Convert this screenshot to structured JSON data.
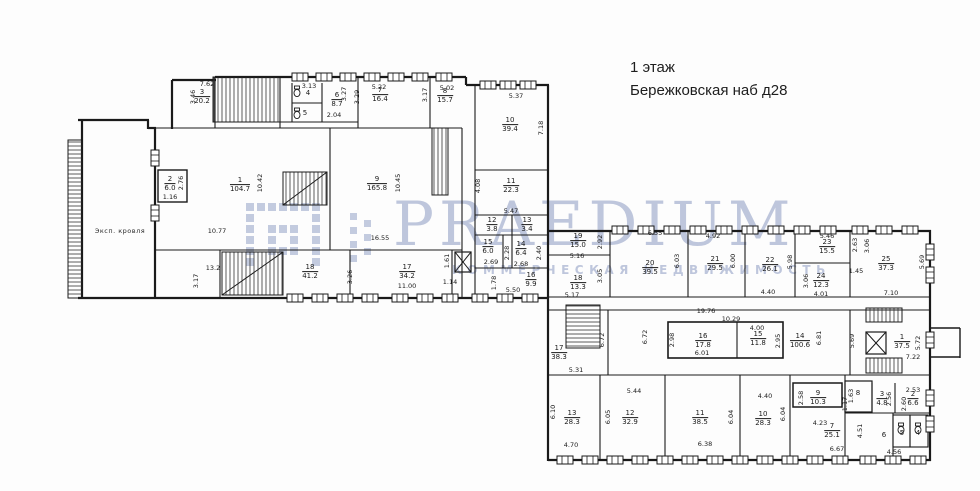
{
  "title": {
    "floor": "1 этаж",
    "address": "Бережковская наб д28"
  },
  "watermark": {
    "brand": "PRAEDIUM",
    "subtitle": "КОММЕРЧЕСКАЯ НЕДВИЖИМОСТЬ",
    "color": "#94a2c6"
  },
  "annotations": {
    "roof": "Эксп. кровля"
  },
  "floorplan": {
    "rooms": [
      {
        "num": "3",
        "area": "20.2",
        "x": 202,
        "y": 97
      },
      {
        "num": "6",
        "area": "8.7",
        "x": 337,
        "y": 100
      },
      {
        "num": "7",
        "area": "16.4",
        "x": 380,
        "y": 95
      },
      {
        "num": "8",
        "area": "15.7",
        "x": 445,
        "y": 96
      },
      {
        "num": "10",
        "area": "39.4",
        "x": 510,
        "y": 125
      },
      {
        "num": "11",
        "area": "22.3",
        "x": 511,
        "y": 186
      },
      {
        "num": "12",
        "area": "3.8",
        "x": 492,
        "y": 225
      },
      {
        "num": "13",
        "area": "3.4",
        "x": 527,
        "y": 225
      },
      {
        "num": "15",
        "area": "6.0",
        "x": 488,
        "y": 247
      },
      {
        "num": "14",
        "area": "6.4",
        "x": 521,
        "y": 249
      },
      {
        "num": "16",
        "area": "9.9",
        "x": 531,
        "y": 280
      },
      {
        "num": "2",
        "area": "6.0",
        "x": 170,
        "y": 184
      },
      {
        "num": "1",
        "area": "104.7",
        "x": 240,
        "y": 185
      },
      {
        "num": "9",
        "area": "165.8",
        "x": 377,
        "y": 184
      },
      {
        "num": "18",
        "area": "41.2",
        "x": 310,
        "y": 272
      },
      {
        "num": "17",
        "area": "34.2",
        "x": 407,
        "y": 272
      },
      {
        "num": "19",
        "area": "15.0",
        "x": 578,
        "y": 241
      },
      {
        "num": "18",
        "area": "13.3",
        "x": 578,
        "y": 283
      },
      {
        "num": "20",
        "area": "39.5",
        "x": 650,
        "y": 268
      },
      {
        "num": "21",
        "area": "29.5",
        "x": 715,
        "y": 264
      },
      {
        "num": "22",
        "area": "26.1",
        "x": 770,
        "y": 265
      },
      {
        "num": "23",
        "area": "15.5",
        "x": 827,
        "y": 247
      },
      {
        "num": "24",
        "area": "12.3",
        "x": 821,
        "y": 281
      },
      {
        "num": "25",
        "area": "37.3",
        "x": 886,
        "y": 264
      },
      {
        "num": "17",
        "area": "38.3",
        "x": 559,
        "y": 353
      },
      {
        "num": "16",
        "area": "17.8",
        "x": 703,
        "y": 341
      },
      {
        "num": "15",
        "area": "11.8",
        "x": 758,
        "y": 339
      },
      {
        "num": "14",
        "area": "100.6",
        "x": 800,
        "y": 341
      },
      {
        "num": "1",
        "area": "37.5",
        "x": 902,
        "y": 342
      },
      {
        "num": "13",
        "area": "28.3",
        "x": 572,
        "y": 418
      },
      {
        "num": "12",
        "area": "32.9",
        "x": 630,
        "y": 418
      },
      {
        "num": "11",
        "area": "38.5",
        "x": 700,
        "y": 418
      },
      {
        "num": "10",
        "area": "28.3",
        "x": 763,
        "y": 419
      },
      {
        "num": "9",
        "area": "10.3",
        "x": 818,
        "y": 398
      },
      {
        "num": "7",
        "area": "25.1",
        "x": 832,
        "y": 431
      },
      {
        "num": "3",
        "area": "4.8",
        "x": 882,
        "y": 399
      },
      {
        "num": "2",
        "area": "6.6",
        "x": 913,
        "y": 399
      }
    ],
    "labels": [
      {
        "text": "4",
        "x": 308,
        "y": 93
      },
      {
        "text": "5",
        "x": 305,
        "y": 113
      },
      {
        "text": "8",
        "x": 858,
        "y": 393
      },
      {
        "text": "6",
        "x": 884,
        "y": 435
      },
      {
        "text": "5",
        "x": 902,
        "y": 433
      },
      {
        "text": "4",
        "x": 918,
        "y": 433
      }
    ],
    "dims": [
      {
        "text": "7.62",
        "x": 207,
        "y": 84
      },
      {
        "text": "3.46",
        "x": 193,
        "y": 97,
        "rot": true
      },
      {
        "text": "3.13",
        "x": 309,
        "y": 86
      },
      {
        "text": "3.27",
        "x": 344,
        "y": 94,
        "rot": true
      },
      {
        "text": "2.04",
        "x": 334,
        "y": 115
      },
      {
        "text": "3.29",
        "x": 357,
        "y": 97,
        "rot": true
      },
      {
        "text": "5.22",
        "x": 379,
        "y": 87
      },
      {
        "text": "5.02",
        "x": 447,
        "y": 88
      },
      {
        "text": "3.17",
        "x": 425,
        "y": 95,
        "rot": true
      },
      {
        "text": "10.42",
        "x": 260,
        "y": 183,
        "rot": true
      },
      {
        "text": "2.76",
        "x": 181,
        "y": 183,
        "rot": true
      },
      {
        "text": "1.16",
        "x": 170,
        "y": 197
      },
      {
        "text": "10.45",
        "x": 398,
        "y": 183,
        "rot": true
      },
      {
        "text": "10.77",
        "x": 217,
        "y": 231
      },
      {
        "text": "16.55",
        "x": 380,
        "y": 238
      },
      {
        "text": "13.2",
        "x": 213,
        "y": 268
      },
      {
        "text": "3.17",
        "x": 196,
        "y": 281,
        "rot": true
      },
      {
        "text": "3.26",
        "x": 350,
        "y": 277,
        "rot": true
      },
      {
        "text": "11.00",
        "x": 407,
        "y": 286
      },
      {
        "text": "1.61",
        "x": 447,
        "y": 261,
        "rot": true
      },
      {
        "text": "1.14",
        "x": 450,
        "y": 282
      },
      {
        "text": "5.37",
        "x": 516,
        "y": 96
      },
      {
        "text": "7.18",
        "x": 541,
        "y": 128,
        "rot": true
      },
      {
        "text": "4.08",
        "x": 478,
        "y": 186,
        "rot": true
      },
      {
        "text": "5.47",
        "x": 511,
        "y": 211
      },
      {
        "text": "2.69",
        "x": 491,
        "y": 262
      },
      {
        "text": "2.28",
        "x": 507,
        "y": 253,
        "rot": true
      },
      {
        "text": "2.68",
        "x": 521,
        "y": 264
      },
      {
        "text": "2.40",
        "x": 539,
        "y": 253,
        "rot": true
      },
      {
        "text": "1.78",
        "x": 494,
        "y": 283,
        "rot": true
      },
      {
        "text": "5.50",
        "x": 513,
        "y": 290
      },
      {
        "text": "2.92",
        "x": 600,
        "y": 242,
        "rot": true
      },
      {
        "text": "5.16",
        "x": 577,
        "y": 256
      },
      {
        "text": "3.05",
        "x": 600,
        "y": 276,
        "rot": true
      },
      {
        "text": "5.17",
        "x": 572,
        "y": 295
      },
      {
        "text": "6.55",
        "x": 655,
        "y": 233
      },
      {
        "text": "6.03",
        "x": 677,
        "y": 261,
        "rot": true
      },
      {
        "text": "4.92",
        "x": 713,
        "y": 236
      },
      {
        "text": "6.00",
        "x": 733,
        "y": 261,
        "rot": true
      },
      {
        "text": "5.98",
        "x": 790,
        "y": 262,
        "rot": true
      },
      {
        "text": "4.40",
        "x": 768,
        "y": 292
      },
      {
        "text": "5.46",
        "x": 827,
        "y": 236
      },
      {
        "text": "2.63",
        "x": 855,
        "y": 245,
        "rot": true
      },
      {
        "text": "3.06",
        "x": 867,
        "y": 246,
        "rot": true
      },
      {
        "text": "1.45",
        "x": 856,
        "y": 271
      },
      {
        "text": "3.06",
        "x": 806,
        "y": 281,
        "rot": true
      },
      {
        "text": "4.01",
        "x": 821,
        "y": 294
      },
      {
        "text": "7.10",
        "x": 891,
        "y": 293
      },
      {
        "text": "5.69",
        "x": 922,
        "y": 262,
        "rot": true
      },
      {
        "text": "5.31",
        "x": 576,
        "y": 370
      },
      {
        "text": "6.72",
        "x": 602,
        "y": 340,
        "rot": true
      },
      {
        "text": "6.72",
        "x": 645,
        "y": 337,
        "rot": true
      },
      {
        "text": "19.76",
        "x": 706,
        "y": 311
      },
      {
        "text": "10.29",
        "x": 731,
        "y": 319
      },
      {
        "text": "2.98",
        "x": 672,
        "y": 340,
        "rot": true
      },
      {
        "text": "4.00",
        "x": 757,
        "y": 328
      },
      {
        "text": "2.95",
        "x": 778,
        "y": 341,
        "rot": true
      },
      {
        "text": "6.01",
        "x": 702,
        "y": 353
      },
      {
        "text": "6.81",
        "x": 819,
        "y": 338,
        "rot": true
      },
      {
        "text": "5.69",
        "x": 852,
        "y": 341,
        "rot": true
      },
      {
        "text": "5.72",
        "x": 918,
        "y": 343,
        "rot": true
      },
      {
        "text": "7.22",
        "x": 913,
        "y": 357
      },
      {
        "text": "6.10",
        "x": 553,
        "y": 412,
        "rot": true
      },
      {
        "text": "4.70",
        "x": 571,
        "y": 445
      },
      {
        "text": "5.44",
        "x": 634,
        "y": 391
      },
      {
        "text": "6.05",
        "x": 608,
        "y": 417,
        "rot": true
      },
      {
        "text": "6.38",
        "x": 705,
        "y": 444
      },
      {
        "text": "6.04",
        "x": 731,
        "y": 417,
        "rot": true
      },
      {
        "text": "6.04",
        "x": 783,
        "y": 414,
        "rot": true
      },
      {
        "text": "4.40",
        "x": 765,
        "y": 396
      },
      {
        "text": "2.58",
        "x": 801,
        "y": 398,
        "rot": true
      },
      {
        "text": "4.23",
        "x": 820,
        "y": 423
      },
      {
        "text": "6.67",
        "x": 837,
        "y": 449
      },
      {
        "text": "1.17",
        "x": 845,
        "y": 404,
        "rot": true
      },
      {
        "text": "1.63",
        "x": 851,
        "y": 396,
        "rot": true
      },
      {
        "text": "4.51",
        "x": 860,
        "y": 431,
        "rot": true
      },
      {
        "text": "2.56",
        "x": 889,
        "y": 399,
        "rot": true
      },
      {
        "text": "2.53",
        "x": 913,
        "y": 390
      },
      {
        "text": "2.60",
        "x": 904,
        "y": 404,
        "rot": true
      },
      {
        "text": "4.56",
        "x": 894,
        "y": 452
      }
    ]
  }
}
